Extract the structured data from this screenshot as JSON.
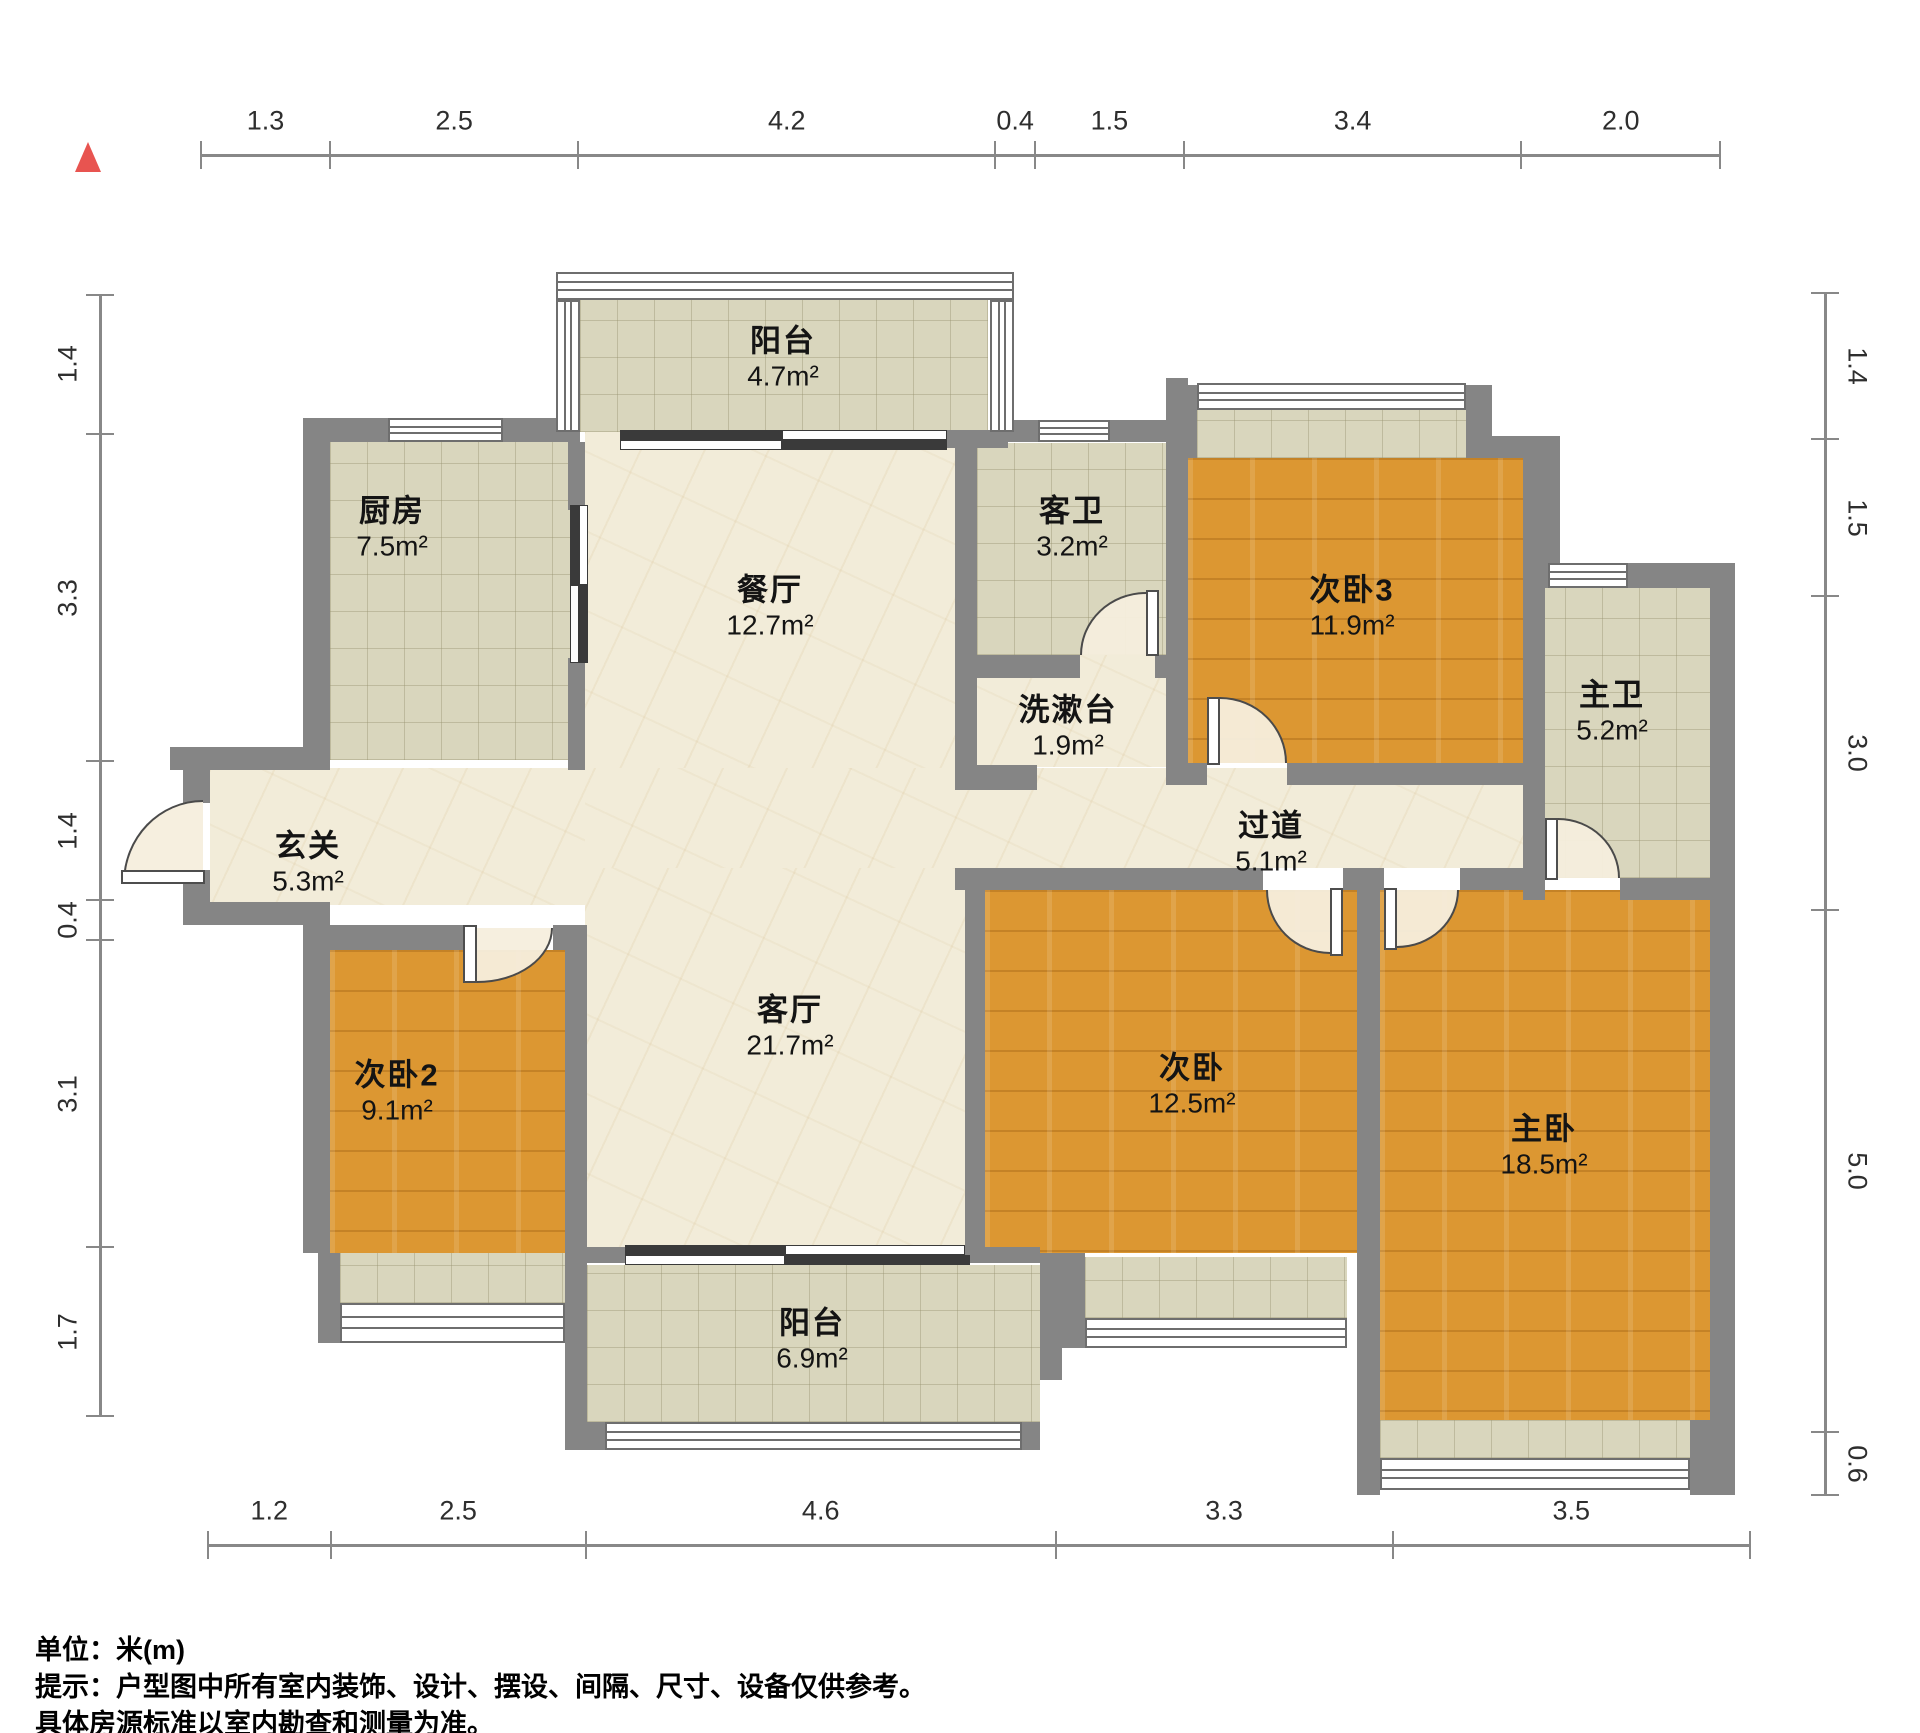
{
  "title": "户型图",
  "unit_note": "单位：米(m)",
  "disclaimer_line1": "提示：户型图中所有室内装饰、设计、摆设、间隔、尺寸、设备仅供参考。",
  "disclaimer_line2": "具体房源标准以室内勘查和测量为准。",
  "north_marker": {
    "icon": "north-triangle-icon",
    "color": "#e85450"
  },
  "dimensions": {
    "top": [
      "1.3",
      "2.5",
      "4.2",
      "0.4",
      "1.5",
      "3.4",
      "2.0"
    ],
    "bottom": [
      "1.2",
      "2.5",
      "4.6",
      "3.3",
      "3.5"
    ],
    "left": [
      "1.4",
      "3.3",
      "1.4",
      "0.4",
      "3.1",
      "1.7"
    ],
    "right": [
      "1.4",
      "1.5",
      "3.0",
      "5.0",
      "0.6"
    ]
  },
  "rooms": [
    {
      "id": "balcony-top",
      "name": "阳台",
      "area": "4.7m²"
    },
    {
      "id": "kitchen",
      "name": "厨房",
      "area": "7.5m²"
    },
    {
      "id": "dining",
      "name": "餐厅",
      "area": "12.7m²"
    },
    {
      "id": "guest-bath",
      "name": "客卫",
      "area": "3.2m²"
    },
    {
      "id": "washstand",
      "name": "洗漱台",
      "area": "1.9m²"
    },
    {
      "id": "bedroom3",
      "name": "次卧3",
      "area": "11.9m²"
    },
    {
      "id": "master-bath",
      "name": "主卫",
      "area": "5.2m²"
    },
    {
      "id": "entry",
      "name": "玄关",
      "area": "5.3m²"
    },
    {
      "id": "hallway",
      "name": "过道",
      "area": "5.1m²"
    },
    {
      "id": "bedroom2",
      "name": "次卧2",
      "area": "9.1m²"
    },
    {
      "id": "living",
      "name": "客厅",
      "area": "21.7m²"
    },
    {
      "id": "bedroom",
      "name": "次卧",
      "area": "12.5m²"
    },
    {
      "id": "master-bedroom",
      "name": "主卧",
      "area": "18.5m²"
    },
    {
      "id": "balcony-bottom",
      "name": "阳台",
      "area": "6.9m²"
    }
  ],
  "colors": {
    "wall": "#858585",
    "wood_floor": "#dc9732",
    "tile_floor": "#d9d6bd",
    "marble_floor": "#f2ecd9"
  }
}
